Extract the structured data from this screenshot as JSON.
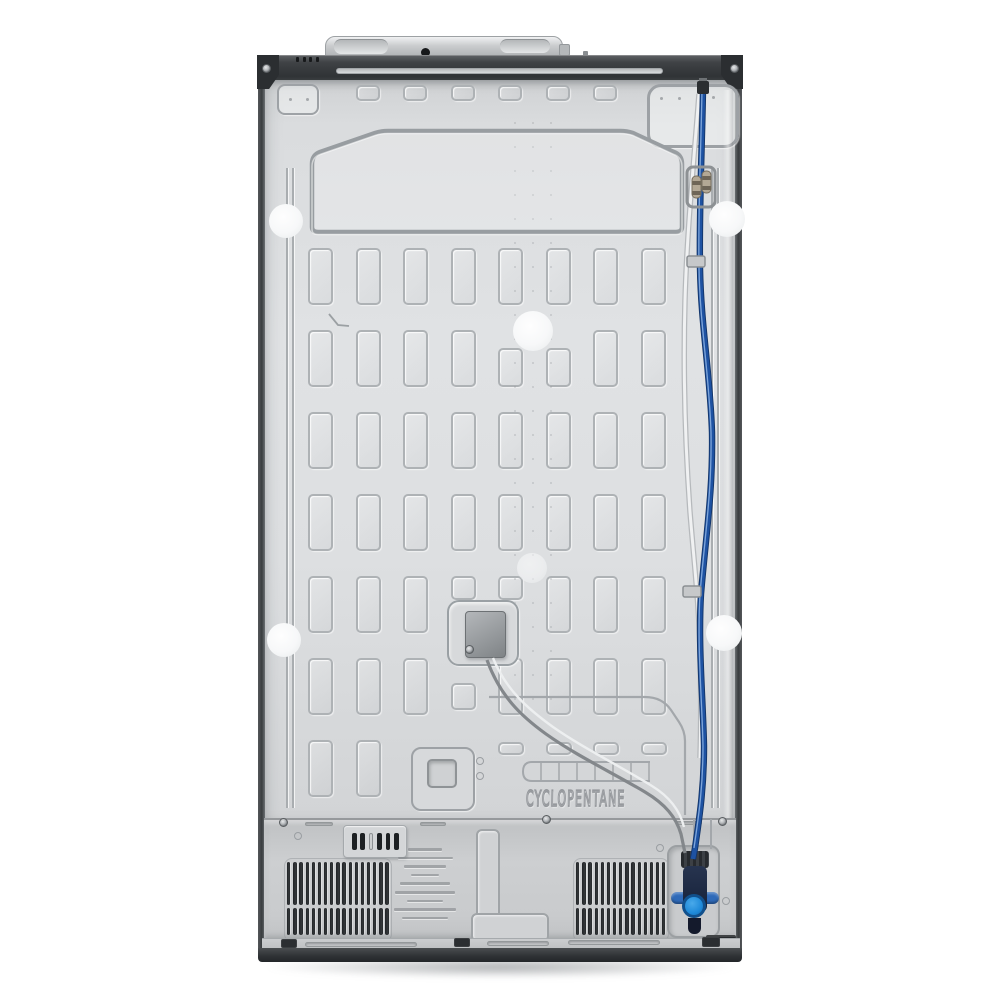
{
  "meta": {
    "type": "product-photo",
    "subject": "refrigerator rear view",
    "background_color": "#ffffff"
  },
  "labels": {
    "cyclopentane": "CYCLOPENTANE"
  },
  "colors": {
    "panel_gray": "#dcdee0",
    "machine_cover_gray": "#c9cbcd",
    "frame_dark": "#3a3d40",
    "emboss_line": "#a6aaad",
    "water_line_blue": "#1e52a2",
    "valve_cap_blue": "#1f8ad9",
    "grille_slat": "#26292c",
    "pad_white": "#f6f7f8"
  },
  "geometry": {
    "grid": {
      "col_x": [
        308,
        356,
        403,
        451,
        498,
        546,
        593,
        641
      ],
      "rect_w": 25,
      "rows": [
        {
          "y": 85,
          "h": 16,
          "w": 24,
          "cols": [
            1,
            2,
            3,
            4,
            5,
            6
          ]
        },
        {
          "y": 248,
          "h": 57,
          "cols": [
            0,
            1,
            2,
            3,
            4,
            5,
            6,
            7
          ]
        },
        {
          "y": 330,
          "h": 57,
          "cols": [
            0,
            1,
            2,
            3,
            6,
            7
          ]
        },
        {
          "y": 348,
          "h": 39,
          "cols": [
            4,
            5
          ]
        },
        {
          "y": 412,
          "h": 57,
          "cols": [
            0,
            1,
            2,
            3,
            4,
            5,
            6,
            7
          ]
        },
        {
          "y": 494,
          "h": 57,
          "cols": [
            0,
            1,
            2,
            3,
            4,
            5,
            6,
            7
          ]
        },
        {
          "y": 576,
          "h": 57,
          "cols": [
            0,
            1,
            2,
            5,
            6,
            7
          ]
        },
        {
          "y": 576,
          "h": 24,
          "cols": [
            3,
            4
          ]
        },
        {
          "y": 658,
          "h": 57,
          "cols": [
            0,
            1,
            2,
            4,
            5,
            6,
            7
          ]
        },
        {
          "y": 683,
          "h": 27,
          "cols": [
            3
          ]
        },
        {
          "y": 740,
          "h": 57,
          "cols": [
            0,
            1
          ]
        },
        {
          "y": 742,
          "h": 13,
          "w": 26,
          "cols": [
            4,
            5,
            6,
            7
          ]
        }
      ]
    },
    "dots": {
      "cols": [
        514,
        532,
        550
      ],
      "y0": 122,
      "y1": 716,
      "step": 24
    },
    "small_dots": [
      [
        289,
        98
      ],
      [
        306,
        98
      ],
      [
        660,
        97
      ],
      [
        678,
        97
      ],
      [
        712,
        96
      ]
    ],
    "grilles": [
      {
        "x0": 287,
        "count": 17,
        "pitch": 6.15,
        "w": 3.4,
        "rows": [
          {
            "y": 862,
            "h": 43
          },
          {
            "y": 908,
            "h": 27
          }
        ]
      },
      {
        "x0": 576,
        "count": 15,
        "pitch": 6.15,
        "w": 3.4,
        "rows": [
          {
            "y": 862,
            "h": 43
          },
          {
            "y": 908,
            "h": 27
          }
        ]
      }
    ],
    "pads": [
      {
        "x": 286,
        "y": 221,
        "r": 17
      },
      {
        "x": 727,
        "y": 219,
        "r": 18
      },
      {
        "x": 533,
        "y": 331,
        "r": 20
      },
      {
        "x": 284,
        "y": 640,
        "r": 17
      },
      {
        "x": 724,
        "y": 633,
        "r": 18
      },
      {
        "x": 532,
        "y": 568,
        "r": 15,
        "faint": true
      }
    ],
    "slot_plate": {
      "x0": 352,
      "pitch": 8.4,
      "y": 833,
      "w": 4.5,
      "h": 17,
      "fills": [
        1,
        1,
        0,
        1,
        1,
        1
      ]
    },
    "rim_slots": [
      [
        305,
        942,
        112
      ],
      [
        487,
        941,
        62
      ],
      [
        568,
        940,
        92
      ]
    ],
    "seam_slots": [
      [
        305,
        822,
        28
      ],
      [
        420,
        822,
        26
      ],
      [
        676,
        821,
        26
      ]
    ],
    "rim_marks": [
      [
        281,
        939,
        16,
        9
      ],
      [
        454,
        938,
        16,
        9
      ],
      [
        702,
        937,
        18,
        10
      ]
    ],
    "screws": [
      [
        283,
        822
      ],
      [
        546,
        819
      ],
      [
        722,
        821
      ],
      [
        266,
        68
      ],
      [
        734,
        68
      ],
      [
        469,
        649
      ]
    ],
    "circle_marks": [
      [
        298,
        836
      ],
      [
        660,
        848
      ],
      [
        726,
        901
      ],
      [
        480,
        761
      ],
      [
        480,
        776
      ]
    ],
    "warning_bars": [
      34,
      55,
      42,
      28,
      50,
      60,
      36,
      62,
      46
    ],
    "rail_dashes": {
      "x0": 296,
      "step": 6.5,
      "count": 4,
      "y": 57,
      "w": 3,
      "h": 5
    }
  }
}
